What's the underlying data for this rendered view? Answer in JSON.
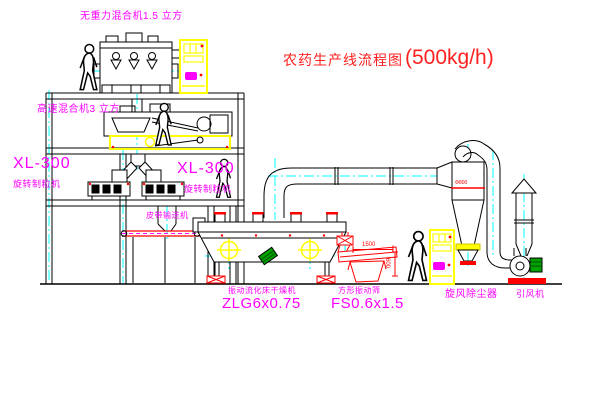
{
  "title": {
    "name": "农药生产线流程图",
    "capacity": "(500kg/h)"
  },
  "labels": {
    "no_gravity_mixer": "无重力混合机1.5 立方",
    "high_speed_mixer": "高速混合机3 立方",
    "granulator_left": {
      "model": "XL-300",
      "name": "旋转制粒机"
    },
    "granulator_right": {
      "model": "XL-300",
      "name": "旋转制粒机"
    },
    "belt_conveyor": "皮带输送机",
    "fluid_bed_dryer": {
      "name": "振动流化床干燥机",
      "model": "ZLG6x0.75"
    },
    "vibrating_screen": {
      "name": "方形振动筛",
      "model": "FS0.6x1.5"
    },
    "cyclone": "旋风除尘器",
    "induced_draft_fan": "引风机"
  },
  "dimensions": {
    "screen_length": "1500",
    "screen_height": "600",
    "cyclone_size": "Φ800"
  },
  "colors": {
    "label_magenta": "#ff00ff",
    "title_red": "#ff2020",
    "line_black": "#000000",
    "equipment_yellow": "#ffff00",
    "centerline_cyan": "#00ffff",
    "equipment_red": "#ff0000",
    "motor_green": "#00a000"
  }
}
